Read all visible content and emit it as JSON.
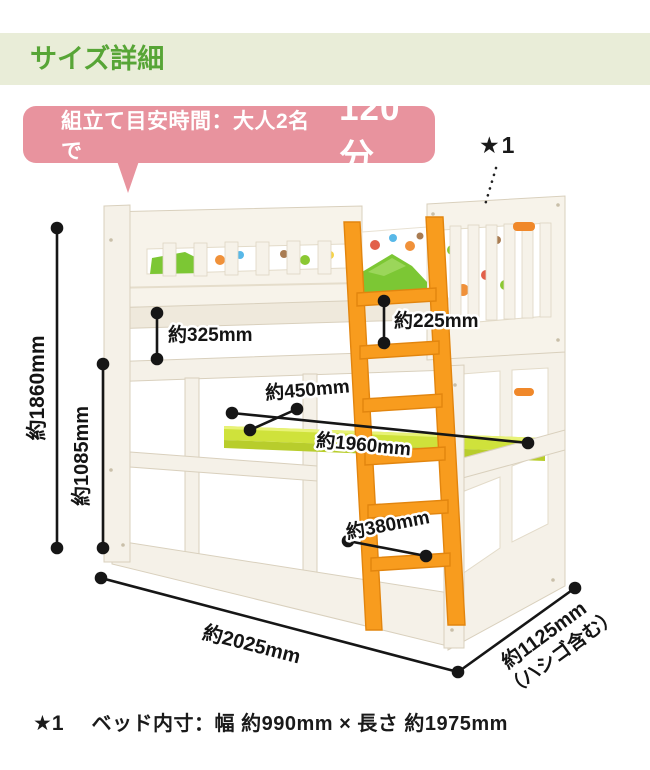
{
  "header": {
    "title": "サイズ詳細"
  },
  "assembly_bubble": {
    "lead": "組立て目安時間：大人2名で",
    "time": "120分"
  },
  "star_note": {
    "marker": "★1"
  },
  "dims": {
    "total_height": "約1860mm",
    "under_height": "約1085mm",
    "rail_top": "約325mm",
    "rail_inner": "約225mm",
    "desk_depth": "約450mm",
    "desk_width": "約1960mm",
    "ladder_width": "約380mm",
    "length": "約2025mm",
    "depth": "約1125mm",
    "depth_note": "（ハシゴ含む）"
  },
  "footnote": {
    "marker": "★1",
    "text": "ベッド内寸：幅 約990mm × 長さ 約1975mm"
  },
  "colors": {
    "header_bg": "#e9edd8",
    "header_text_green": "#57a536",
    "bubble_pink": "#e8939e",
    "ladder_orange": "#f89c1e",
    "desk_green": "#cfe23b",
    "bed_wood_white": "#f5f1e8",
    "dimension_black": "#161616"
  }
}
